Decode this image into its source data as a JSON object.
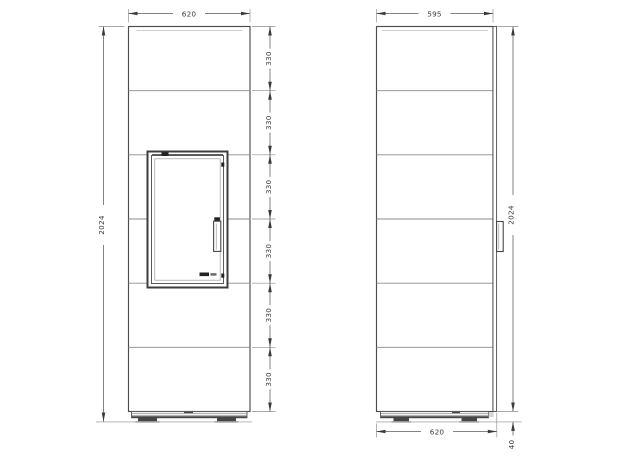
{
  "dims": {
    "front": {
      "width": "620",
      "height": "2024",
      "segments": [
        "330",
        "330",
        "330",
        "330",
        "330",
        "330"
      ]
    },
    "side": {
      "depth": "595",
      "height": "2024",
      "base_depth": "620",
      "base_height": "40"
    }
  },
  "colors": {
    "line": "#4b4b4b",
    "panel": "#8a8a8a",
    "dim": "#5a5a5a",
    "text": "#3a3a3a",
    "dark": "#2e2e2e",
    "bg": "#ffffff"
  }
}
